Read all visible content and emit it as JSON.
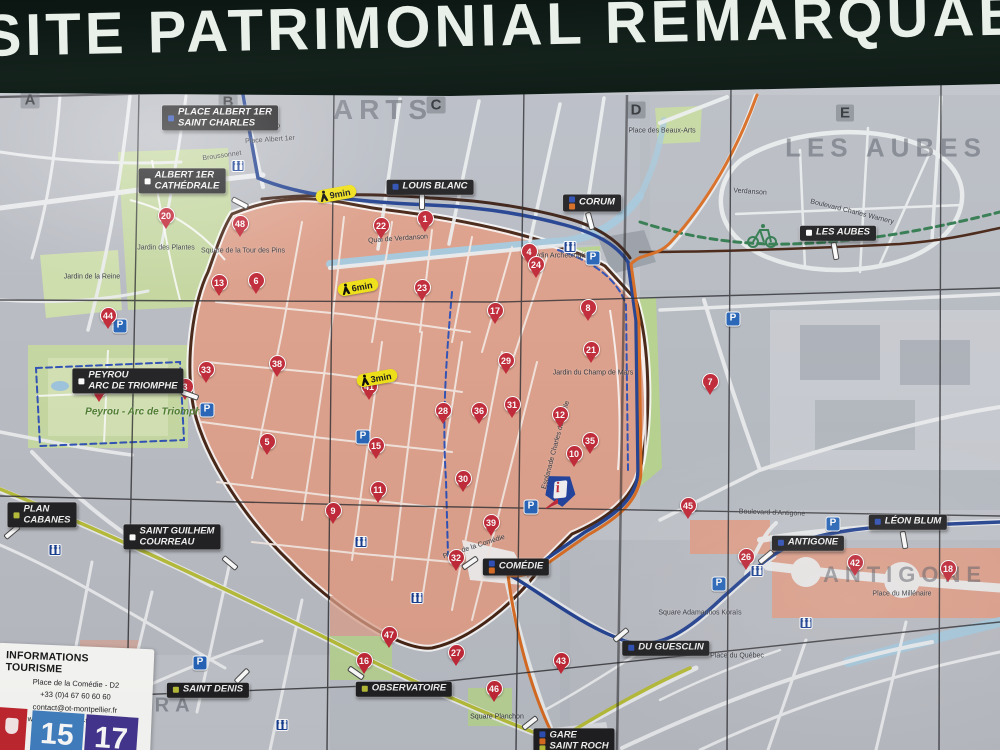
{
  "banner": {
    "title": "SITE PATRIMONIAL REMARQUABLE"
  },
  "info_box": {
    "title": "INFORMATIONS TOURISME",
    "lines": [
      "Place de la Comédie - D2",
      "+33 (0)4 67 60 60 60",
      "contact@ot-montpellier.fr",
      "www.montpellier-tourisme.fr"
    ]
  },
  "line_badges": [
    {
      "label": "15"
    },
    {
      "label": "17"
    }
  ],
  "icons": {
    "parking_glyph": "P",
    "tourist_logo_glyph": "i"
  },
  "colors": {
    "pin_red": "#c22433",
    "label_bg": "#1c1c1e",
    "park_green": "#c6d9a0",
    "historic_salmon": "#dfa08a",
    "tram_blue": "#1e3e8f",
    "tram_orange": "#d96a1e",
    "line_olive": "#b7bd35",
    "bike_green": "#2f7a4d",
    "river_blue": "#a6c9dd",
    "badge_yellow": "#f2e20f",
    "parking_blue": "#2262b8"
  },
  "grid_letters": [
    {
      "t": "A",
      "x": 30,
      "y": 100
    },
    {
      "t": "B",
      "x": 228,
      "y": 102
    },
    {
      "t": "C",
      "x": 436,
      "y": 105
    },
    {
      "t": "D",
      "x": 636,
      "y": 110
    },
    {
      "t": "E",
      "x": 845,
      "y": 113
    },
    {
      "t": "A",
      "x": 50,
      "y": 654
    }
  ],
  "area_texts": [
    {
      "t": "ARTS",
      "x": 383,
      "y": 110,
      "size": 28
    },
    {
      "t": "LES AUBES",
      "x": 886,
      "y": 148,
      "size": 26
    },
    {
      "t": "ANTIGONE",
      "x": 905,
      "y": 575,
      "size": 22
    },
    {
      "t": "TRA",
      "x": 166,
      "y": 706,
      "size": 20
    }
  ],
  "place_texts": [
    {
      "t": "Place Albert 1er",
      "x": 270,
      "y": 140,
      "rot": -4
    },
    {
      "t": "Jardin des Plantes",
      "x": 166,
      "y": 248,
      "rot": 0
    },
    {
      "t": "Jardin de la Reine",
      "x": 92,
      "y": 277,
      "rot": 0
    },
    {
      "t": "Square de la Tour des Pins",
      "x": 243,
      "y": 251,
      "rot": 0
    },
    {
      "t": "Place des Beaux-Arts",
      "x": 662,
      "y": 131,
      "rot": 0
    },
    {
      "t": "Jardin Archéologique",
      "x": 562,
      "y": 256,
      "rot": 0
    },
    {
      "t": "Jardin du Champ de Mars",
      "x": 593,
      "y": 373,
      "rot": 0
    },
    {
      "t": "Esplanade Charles de Gaulle",
      "x": 556,
      "y": 445,
      "rot": -75
    },
    {
      "t": "Peyrou - Arc de Triomphe",
      "x": 146,
      "y": 412,
      "rot": 0,
      "green": true
    },
    {
      "t": "Place de la Comédie",
      "x": 474,
      "y": 547,
      "rot": -18
    },
    {
      "t": "Square Planchon",
      "x": 497,
      "y": 717,
      "rot": 0
    },
    {
      "t": "Place du Québec",
      "x": 737,
      "y": 656,
      "rot": 0
    },
    {
      "t": "Square Adamantios Koraïs",
      "x": 700,
      "y": 613,
      "rot": 0
    },
    {
      "t": "Place du Millénaire",
      "x": 902,
      "y": 594,
      "rot": 0
    },
    {
      "t": "Broussonnet",
      "x": 222,
      "y": 156,
      "rot": -8
    },
    {
      "t": "Quai de Verdanson",
      "x": 398,
      "y": 239,
      "rot": -4
    },
    {
      "t": "Verdanson",
      "x": 750,
      "y": 192,
      "rot": 4
    },
    {
      "t": "Boulevard Charles Warnery",
      "x": 852,
      "y": 212,
      "rot": 14
    },
    {
      "t": "Boulevard d'Antigone",
      "x": 772,
      "y": 513,
      "rot": 2
    }
  ],
  "map_labels": [
    {
      "lines": [
        "PLACE ALBERT 1ER",
        "SAINT CHARLES"
      ],
      "x": 220,
      "y": 118,
      "icons": [
        "#2a4db5"
      ],
      "rod": [
        52,
        4,
        40
      ]
    },
    {
      "lines": [
        "ALBERT 1ER",
        "CATHÉDRALE"
      ],
      "x": 182,
      "y": 181,
      "icons": [
        "#ffffff"
      ],
      "rod": [
        58,
        22,
        28
      ]
    },
    {
      "lines": [
        "LOUIS BLANC"
      ],
      "x": 430,
      "y": 187,
      "icons": [
        "#2a4db5"
      ],
      "rod": [
        -8,
        14,
        90
      ]
    },
    {
      "lines": [
        "CORUM"
      ],
      "x": 592,
      "y": 203,
      "icons": [
        "#2a4db5",
        "#d96a1e"
      ],
      "rod": [
        -2,
        18,
        75
      ]
    },
    {
      "lines": [
        "LES AUBES"
      ],
      "x": 838,
      "y": 233,
      "icons": [
        "#ffffff"
      ],
      "rod": [
        -3,
        18,
        80
      ]
    },
    {
      "lines": [
        "PEYROU",
        "ARC DE TRIOMPHE"
      ],
      "x": 128,
      "y": 381,
      "icons": [
        "#ffffff"
      ],
      "rod": [
        62,
        14,
        20
      ]
    },
    {
      "lines": [
        "PLAN",
        "CABANES"
      ],
      "x": 42,
      "y": 515,
      "icons": [
        "#b7bd35"
      ],
      "rod": [
        -30,
        17,
        -40
      ]
    },
    {
      "lines": [
        "SAINT GUILHEM",
        "COURREAU"
      ],
      "x": 172,
      "y": 537,
      "icons": [
        "#ffffff"
      ],
      "rod": [
        58,
        26,
        40
      ]
    },
    {
      "lines": [
        "LÉON BLUM"
      ],
      "x": 908,
      "y": 522,
      "icons": [
        "#2a4db5"
      ],
      "rod": [
        -4,
        18,
        80
      ]
    },
    {
      "lines": [
        "ANTIGONE"
      ],
      "x": 808,
      "y": 543,
      "icons": [
        "#2a4db5"
      ],
      "rod": [
        -42,
        14,
        -40
      ]
    },
    {
      "lines": [
        "COMÉDIE"
      ],
      "x": 516,
      "y": 567,
      "icons": [
        "#2a4db5",
        "#d96a1e"
      ],
      "rod": [
        -46,
        -4,
        -35
      ]
    },
    {
      "lines": [
        "DU GUESCLIN"
      ],
      "x": 666,
      "y": 648,
      "icons": [
        "#2a4db5"
      ],
      "rod": [
        -45,
        -13,
        -40
      ]
    },
    {
      "lines": [
        "SAINT DENIS"
      ],
      "x": 208,
      "y": 690,
      "icons": [
        "#b7bd35"
      ],
      "rod": [
        34,
        -14,
        -45
      ]
    },
    {
      "lines": [
        "OBSERVATOIRE"
      ],
      "x": 404,
      "y": 689,
      "icons": [
        "#b7bd35"
      ],
      "rod": [
        -48,
        -16,
        35
      ]
    },
    {
      "lines": [
        "GARE",
        "SAINT ROCH"
      ],
      "x": 574,
      "y": 741,
      "icons": [
        "#2a4db5",
        "#d96a1e",
        "#b7bd35"
      ],
      "rod": [
        -44,
        -18,
        -38
      ]
    }
  ],
  "markers": [
    {
      "n": 1,
      "x": 425,
      "y": 229
    },
    {
      "n": 3,
      "x": 185,
      "y": 397
    },
    {
      "n": 4,
      "x": 529,
      "y": 262
    },
    {
      "n": 5,
      "x": 267,
      "y": 452
    },
    {
      "n": 6,
      "x": 256,
      "y": 291
    },
    {
      "n": 7,
      "x": 710,
      "y": 392
    },
    {
      "n": 8,
      "x": 588,
      "y": 318
    },
    {
      "n": 9,
      "x": 333,
      "y": 521
    },
    {
      "n": 10,
      "x": 574,
      "y": 464
    },
    {
      "n": 11,
      "x": 378,
      "y": 500
    },
    {
      "n": 12,
      "x": 560,
      "y": 425
    },
    {
      "n": 13,
      "x": 219,
      "y": 293
    },
    {
      "n": 15,
      "x": 376,
      "y": 456
    },
    {
      "n": 16,
      "x": 364,
      "y": 671
    },
    {
      "n": 17,
      "x": 495,
      "y": 321
    },
    {
      "n": 18,
      "x": 948,
      "y": 579
    },
    {
      "n": 20,
      "x": 166,
      "y": 226
    },
    {
      "n": 21,
      "x": 591,
      "y": 360
    },
    {
      "n": 22,
      "x": 381,
      "y": 236
    },
    {
      "n": 23,
      "x": 422,
      "y": 298
    },
    {
      "n": 24,
      "x": 536,
      "y": 275
    },
    {
      "n": 26,
      "x": 746,
      "y": 567
    },
    {
      "n": 27,
      "x": 456,
      "y": 663
    },
    {
      "n": 28,
      "x": 443,
      "y": 421
    },
    {
      "n": 29,
      "x": 506,
      "y": 371
    },
    {
      "n": 30,
      "x": 463,
      "y": 489
    },
    {
      "n": 31,
      "x": 512,
      "y": 415
    },
    {
      "n": 32,
      "x": 456,
      "y": 568
    },
    {
      "n": 33,
      "x": 206,
      "y": 380
    },
    {
      "n": 35,
      "x": 590,
      "y": 451
    },
    {
      "n": 36,
      "x": 479,
      "y": 421
    },
    {
      "n": 38,
      "x": 277,
      "y": 374
    },
    {
      "n": 39,
      "x": 491,
      "y": 533
    },
    {
      "n": 40,
      "x": 99,
      "y": 399
    },
    {
      "n": 41,
      "x": 369,
      "y": 397
    },
    {
      "n": 42,
      "x": 855,
      "y": 573
    },
    {
      "n": 43,
      "x": 561,
      "y": 671
    },
    {
      "n": 44,
      "x": 108,
      "y": 326
    },
    {
      "n": 45,
      "x": 688,
      "y": 516
    },
    {
      "n": 46,
      "x": 494,
      "y": 699
    },
    {
      "n": 47,
      "x": 389,
      "y": 645
    },
    {
      "n": 48,
      "x": 240,
      "y": 234
    }
  ],
  "walk_badges": [
    {
      "t": "9min",
      "x": 336,
      "y": 194
    },
    {
      "t": "6min",
      "x": 358,
      "y": 287
    },
    {
      "t": "3min",
      "x": 377,
      "y": 378
    }
  ],
  "parking": [
    {
      "x": 120,
      "y": 326
    },
    {
      "x": 207,
      "y": 410
    },
    {
      "x": 593,
      "y": 258
    },
    {
      "x": 733,
      "y": 319
    },
    {
      "x": 363,
      "y": 437
    },
    {
      "x": 200,
      "y": 663
    },
    {
      "x": 531,
      "y": 507
    },
    {
      "x": 833,
      "y": 524
    },
    {
      "x": 719,
      "y": 584
    }
  ],
  "transit_stops": [
    {
      "x": 238,
      "y": 166
    },
    {
      "x": 570,
      "y": 247
    },
    {
      "x": 55,
      "y": 550
    },
    {
      "x": 282,
      "y": 725
    },
    {
      "x": 361,
      "y": 542
    },
    {
      "x": 417,
      "y": 598
    },
    {
      "x": 757,
      "y": 571
    },
    {
      "x": 806,
      "y": 623
    }
  ],
  "tourist_logo": {
    "x": 560,
    "y": 491
  }
}
